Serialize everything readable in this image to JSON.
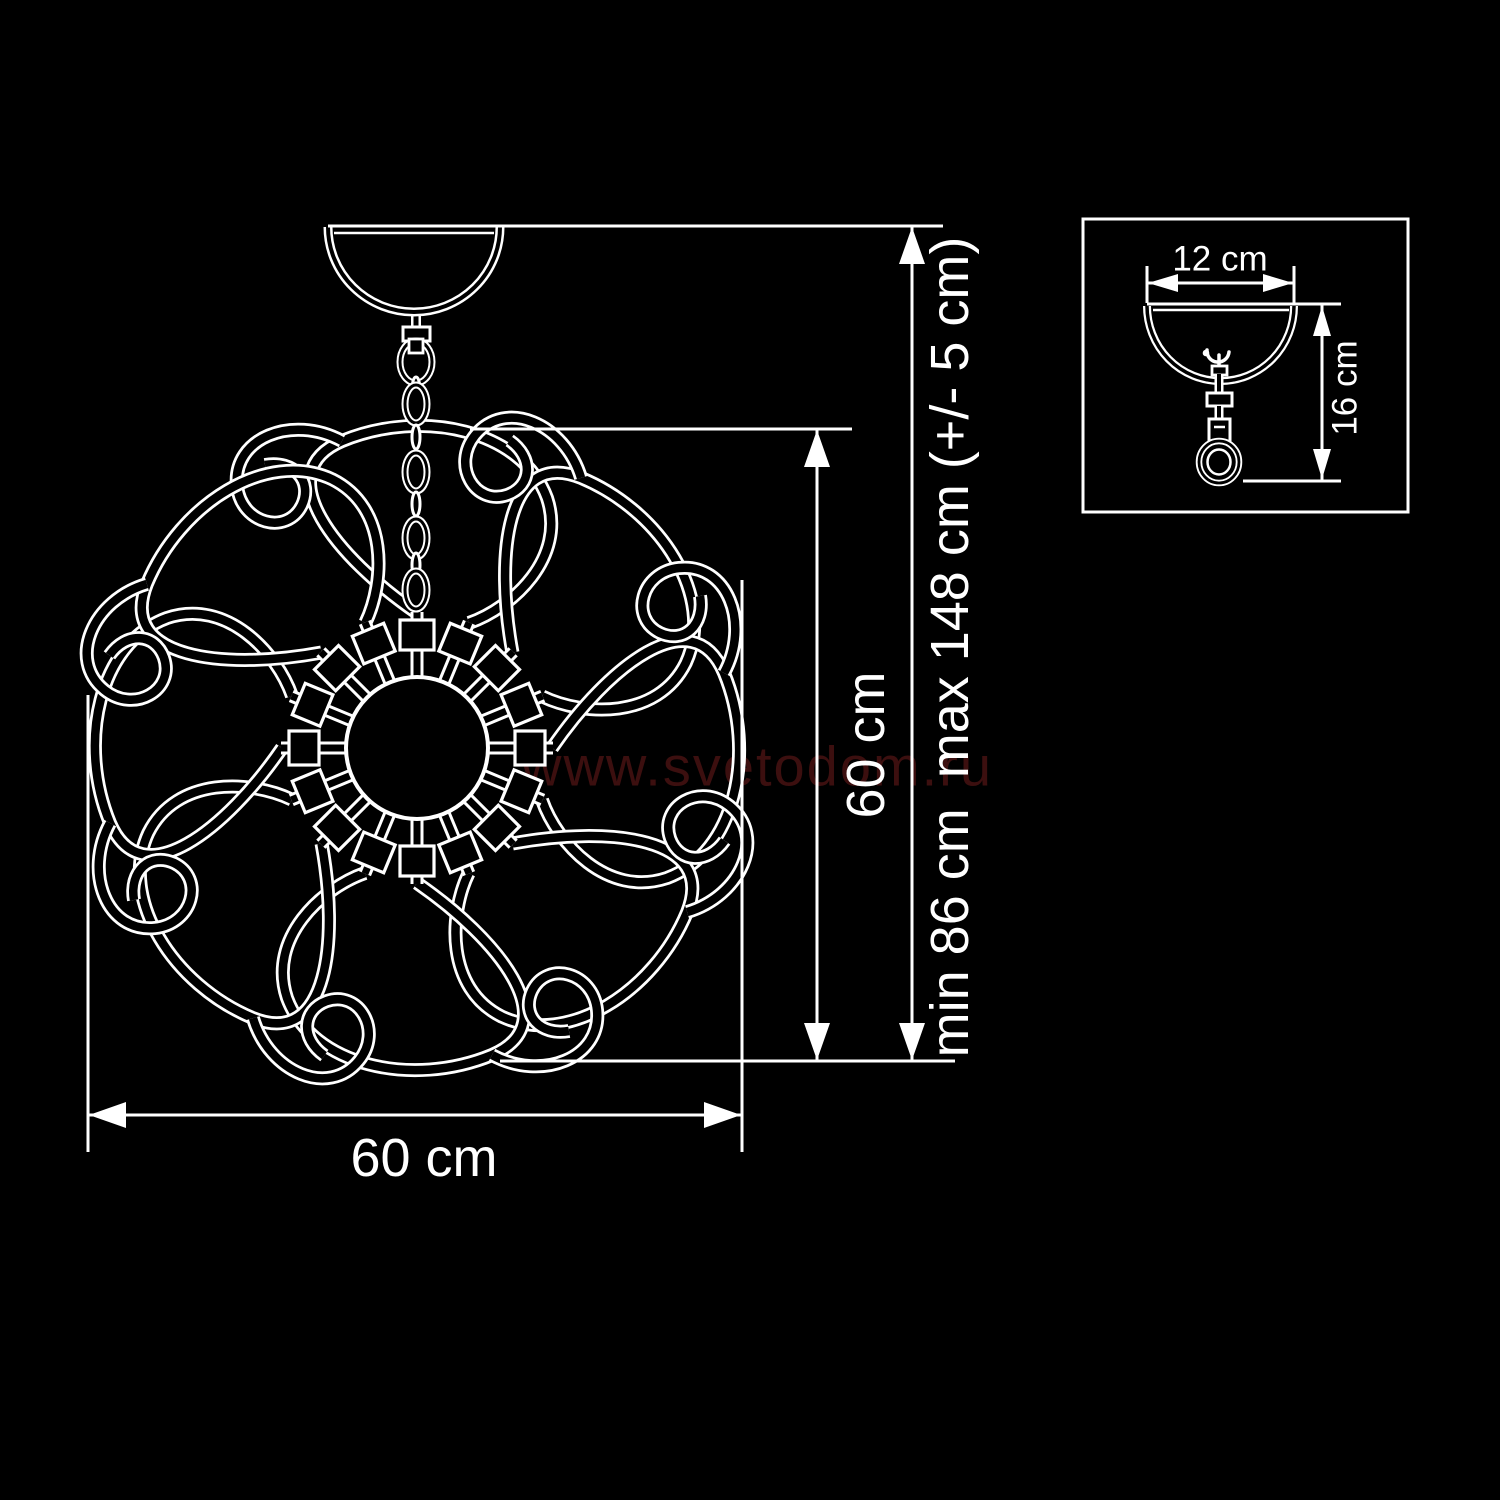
{
  "colors": {
    "bg": "#000000",
    "line": "#ffffff",
    "watermark": "#3c0f0f"
  },
  "watermark": {
    "text": "www.svetodom.ru"
  },
  "main_view": {
    "width_label": "60 cm",
    "height_label": "60 cm",
    "suspension_label": "min 86 cm  max 148 cm (+/- 5 cm)"
  },
  "detail_view": {
    "canopy_width_label": "12 cm",
    "canopy_height_label": "16 cm"
  }
}
